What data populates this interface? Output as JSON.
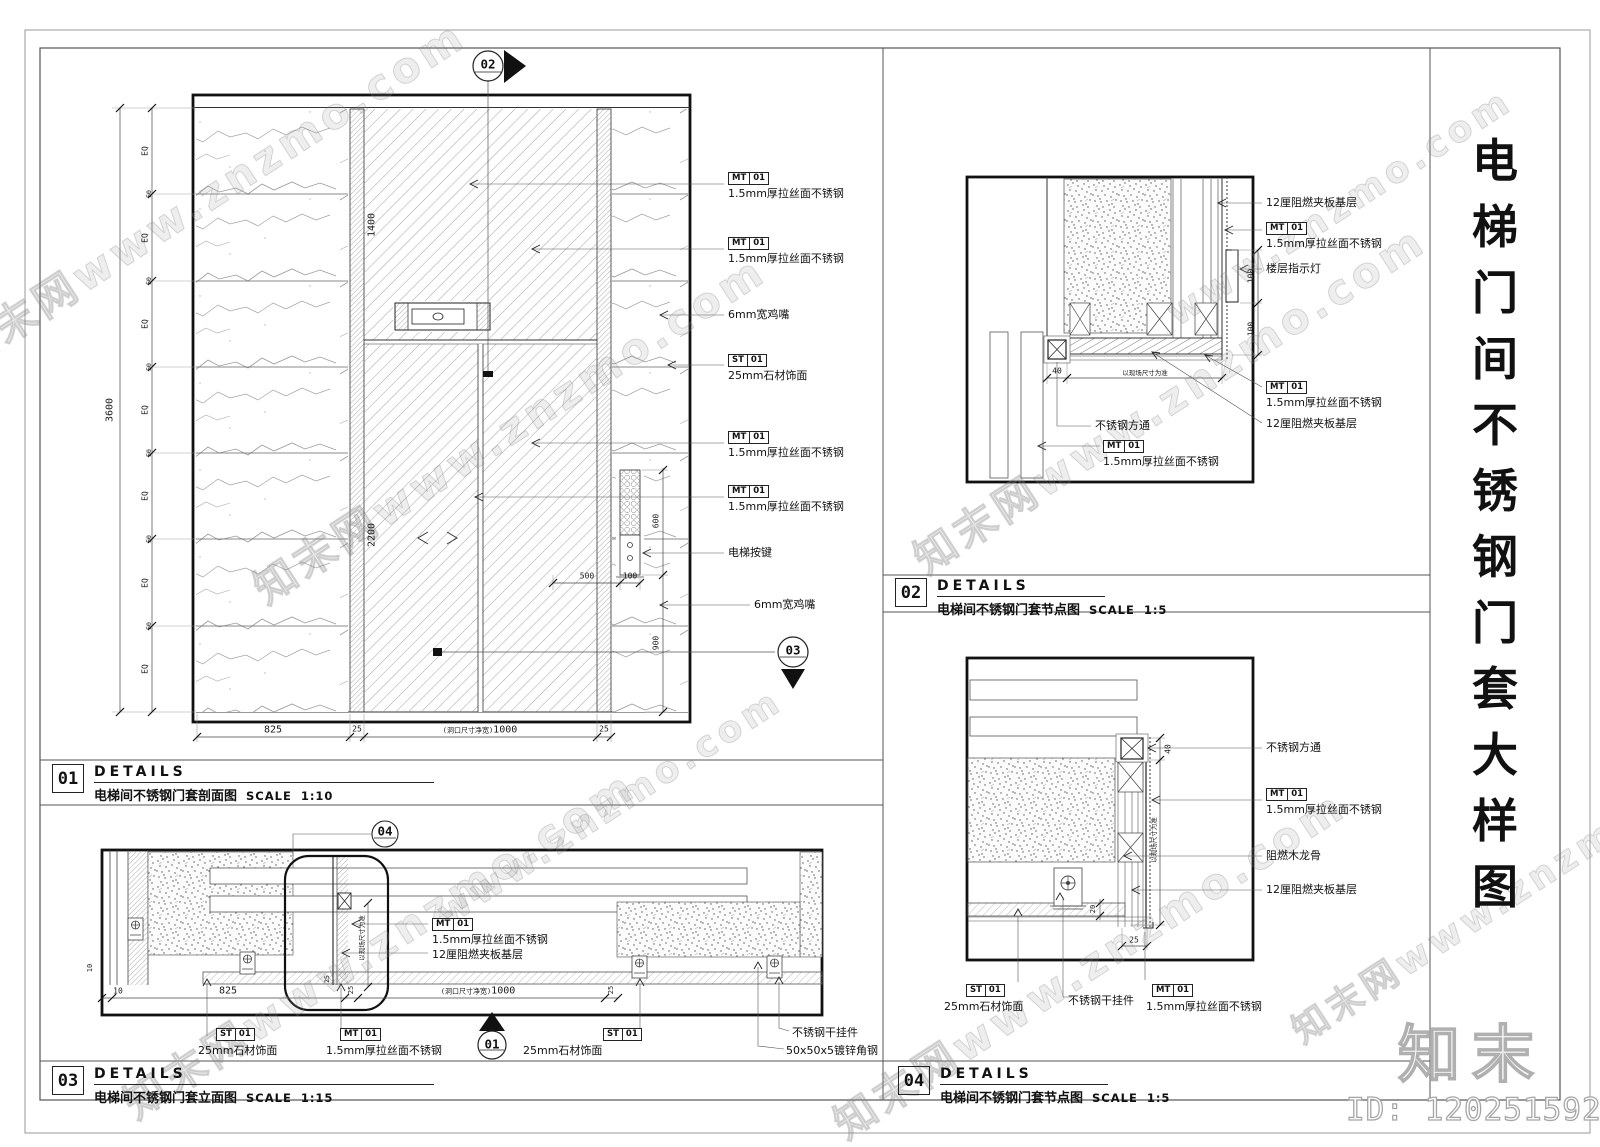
{
  "sheet": {
    "side_title_chars": [
      "电",
      "梯",
      "门",
      "间",
      "不",
      "锈",
      "钢",
      "门",
      "套",
      "大",
      "样",
      "图"
    ],
    "brand_logo": "知末",
    "id_text": "ID: 1202515925",
    "watermark_text": "知末网www.znzmo.com",
    "watermark_short": "www.znzmo.com"
  },
  "title_blocks": [
    {
      "num": "01",
      "heading": "DETAILS",
      "title": "电梯间不锈钢门套剖面图",
      "scale_label": "SCALE",
      "scale_value": "1:10"
    },
    {
      "num": "02",
      "heading": "DETAILS",
      "title": "电梯间不锈钢门套节点图",
      "scale_label": "SCALE",
      "scale_value": "1:5"
    },
    {
      "num": "03",
      "heading": "DETAILS",
      "title": "电梯间不锈钢门套立面图",
      "scale_label": "SCALE",
      "scale_value": "1:15"
    },
    {
      "num": "04",
      "heading": "DETAILS",
      "title": "电梯间不锈钢门套节点图",
      "scale_label": "SCALE",
      "scale_value": "1:5"
    }
  ],
  "markers": {
    "top_section": "02",
    "right_section": "03",
    "plan_detail": "04",
    "bottom_section": "01"
  },
  "d01": {
    "dims": {
      "overall": "3600",
      "eq": "EQ",
      "joint": "50",
      "transom_h": "1400",
      "door_h": "2200",
      "w_stone": "825",
      "w_25_left": "25",
      "opening_note": "(洞口尺寸净宽)",
      "opening_w": "1000",
      "w_25_right": "25",
      "btn_offset": "500",
      "btn_w": "100",
      "btn_h": "600",
      "btn_bottom": "900"
    },
    "ann": [
      {
        "tag": "MT",
        "no": "01",
        "text": "1.5mm厚拉丝面不锈钢"
      },
      {
        "tag": "MT",
        "no": "01",
        "text": "1.5mm厚拉丝面不锈钢"
      },
      {
        "text": "6mm宽鸡嘴"
      },
      {
        "tag": "ST",
        "no": "01",
        "text": "25mm石材饰面"
      },
      {
        "tag": "MT",
        "no": "01",
        "text": "1.5mm厚拉丝面不锈钢"
      },
      {
        "tag": "MT",
        "no": "01",
        "text": "1.5mm厚拉丝面不锈钢"
      },
      {
        "text": "电梯按键"
      },
      {
        "text": "6mm宽鸡嘴"
      }
    ]
  },
  "d02": {
    "dims": {
      "offset": "40",
      "site_note": "以现场尺寸为准",
      "h_upper": "100",
      "h_lower": "100"
    },
    "ann": [
      {
        "text": "12厘阻燃夹板基层"
      },
      {
        "tag": "MT",
        "no": "01",
        "text": "1.5mm厚拉丝面不锈钢"
      },
      {
        "text": "楼层指示灯"
      },
      {
        "tag": "MT",
        "no": "01",
        "text": "1.5mm厚拉丝面不锈钢"
      },
      {
        "text": "12厘阻燃夹板基层"
      },
      {
        "text": "不锈钢方通"
      },
      {
        "tag": "MT",
        "no": "01",
        "text": "1.5mm厚拉丝面不锈钢"
      }
    ]
  },
  "d03": {
    "dims": {
      "edge": "10",
      "edge2": "10",
      "w_stone": "825",
      "w_25_left": "25",
      "opening_note": "(洞口尺寸净宽)",
      "opening_w": "1000",
      "w_25_right": "25",
      "jamb_25": "25",
      "site_note": "以现场尺寸为准"
    },
    "ann": [
      {
        "tag": "MT",
        "no": "01",
        "text": "1.5mm厚拉丝面不锈钢"
      },
      {
        "text": "12厘阻燃夹板基层"
      },
      {
        "tag": "ST",
        "no": "01",
        "text": "25mm石材饰面"
      },
      {
        "tag": "MT",
        "no": "01",
        "text": "1.5mm厚拉丝面不锈钢"
      },
      {
        "tag": "ST",
        "no": "01",
        "text": "25mm石材饰面"
      },
      {
        "text": "不锈钢干挂件"
      },
      {
        "text": "50x50x5镀锌角钢"
      }
    ]
  },
  "d04": {
    "dims": {
      "tube": "40",
      "site_note": "以现场尺寸为准",
      "gap": "20",
      "face": "25"
    },
    "ann": [
      {
        "text": "不锈钢方通"
      },
      {
        "tag": "MT",
        "no": "01",
        "text": "1.5mm厚拉丝面不锈钢"
      },
      {
        "text": "阻燃木龙骨"
      },
      {
        "text": "12厘阻燃夹板基层"
      },
      {
        "tag": "ST",
        "no": "01",
        "text": "25mm石材饰面"
      },
      {
        "text": "不锈钢干挂件"
      },
      {
        "tag": "MT",
        "no": "01",
        "text": "1.5mm厚拉丝面不锈钢"
      }
    ]
  }
}
